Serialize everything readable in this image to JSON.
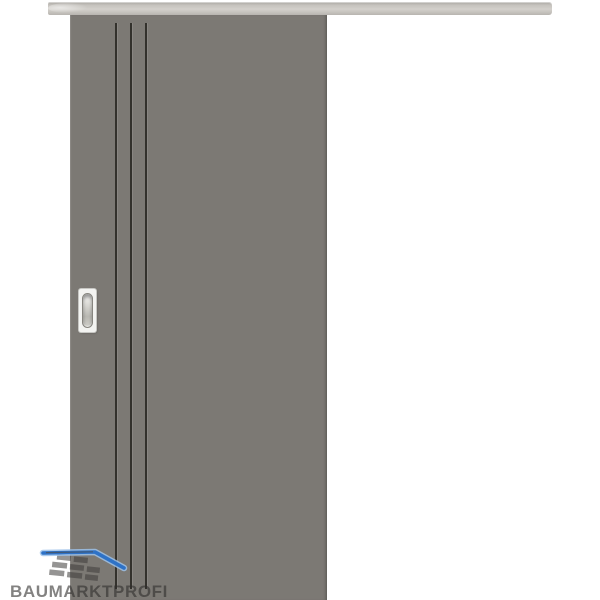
{
  "watermark": {
    "brand": "BAUMARKTPROFI"
  },
  "product": {
    "groove_count": 3,
    "handle_type": "oval-flush-pull"
  },
  "icons": {
    "brand_logo": "roof-over-bricks-icon"
  },
  "colors": {
    "door": "#7c7974",
    "rail": "#d3d0cb",
    "groove": "#33312c",
    "handle_plate": "#f3f3f1",
    "logo_blue": "#2e72c7",
    "logo_gray": "#3e3d3b",
    "background": "#ffffff"
  }
}
